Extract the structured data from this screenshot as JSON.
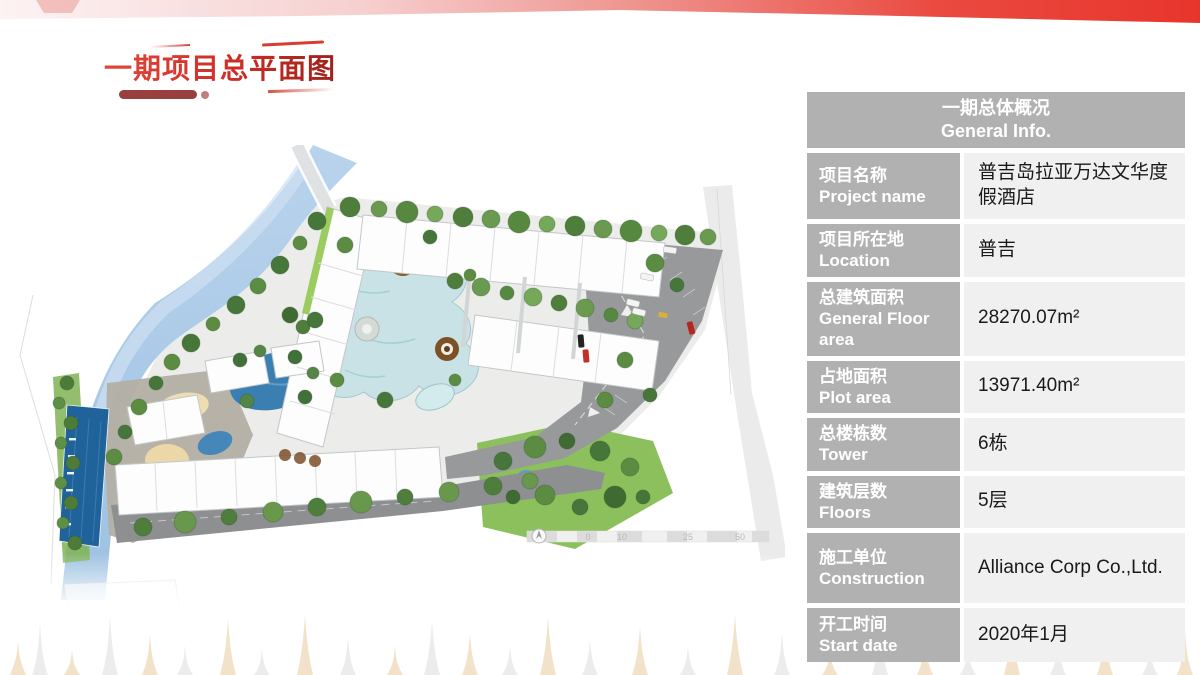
{
  "slide": {
    "title": "一期项目总平面图",
    "accent_red": "#e8352c",
    "table_header_gray": "#b1b1b1",
    "table_value_bg": "#f0f0f0"
  },
  "plan": {
    "scale_labels": [
      "0",
      "10",
      "25",
      "50"
    ]
  },
  "table": {
    "header": {
      "zh": "一期总体概况",
      "en": "General Info."
    },
    "rows": [
      {
        "label_zh": "项目名称",
        "label_en": "Project name",
        "value": "普吉岛拉亚万达文华度假酒店"
      },
      {
        "label_zh": "项目所在地",
        "label_en": "Location",
        "value": "普吉"
      },
      {
        "label_zh": "总建筑面积",
        "label_en": "General Floor area",
        "value": "28270.07m²"
      },
      {
        "label_zh": "占地面积",
        "label_en": "Plot area",
        "value": "13971.40m²"
      },
      {
        "label_zh": "总楼栋数",
        "label_en": "Tower",
        "value": "6栋"
      },
      {
        "label_zh": "建筑层数",
        "label_en": "Floors",
        "value": "5层"
      },
      {
        "label_zh": "施工单位",
        "label_en": "Construction",
        "value": "Alliance Corp Co.,Ltd."
      },
      {
        "label_zh": "开工时间",
        "label_en": "Start date",
        "value": "2020年1月"
      }
    ]
  }
}
